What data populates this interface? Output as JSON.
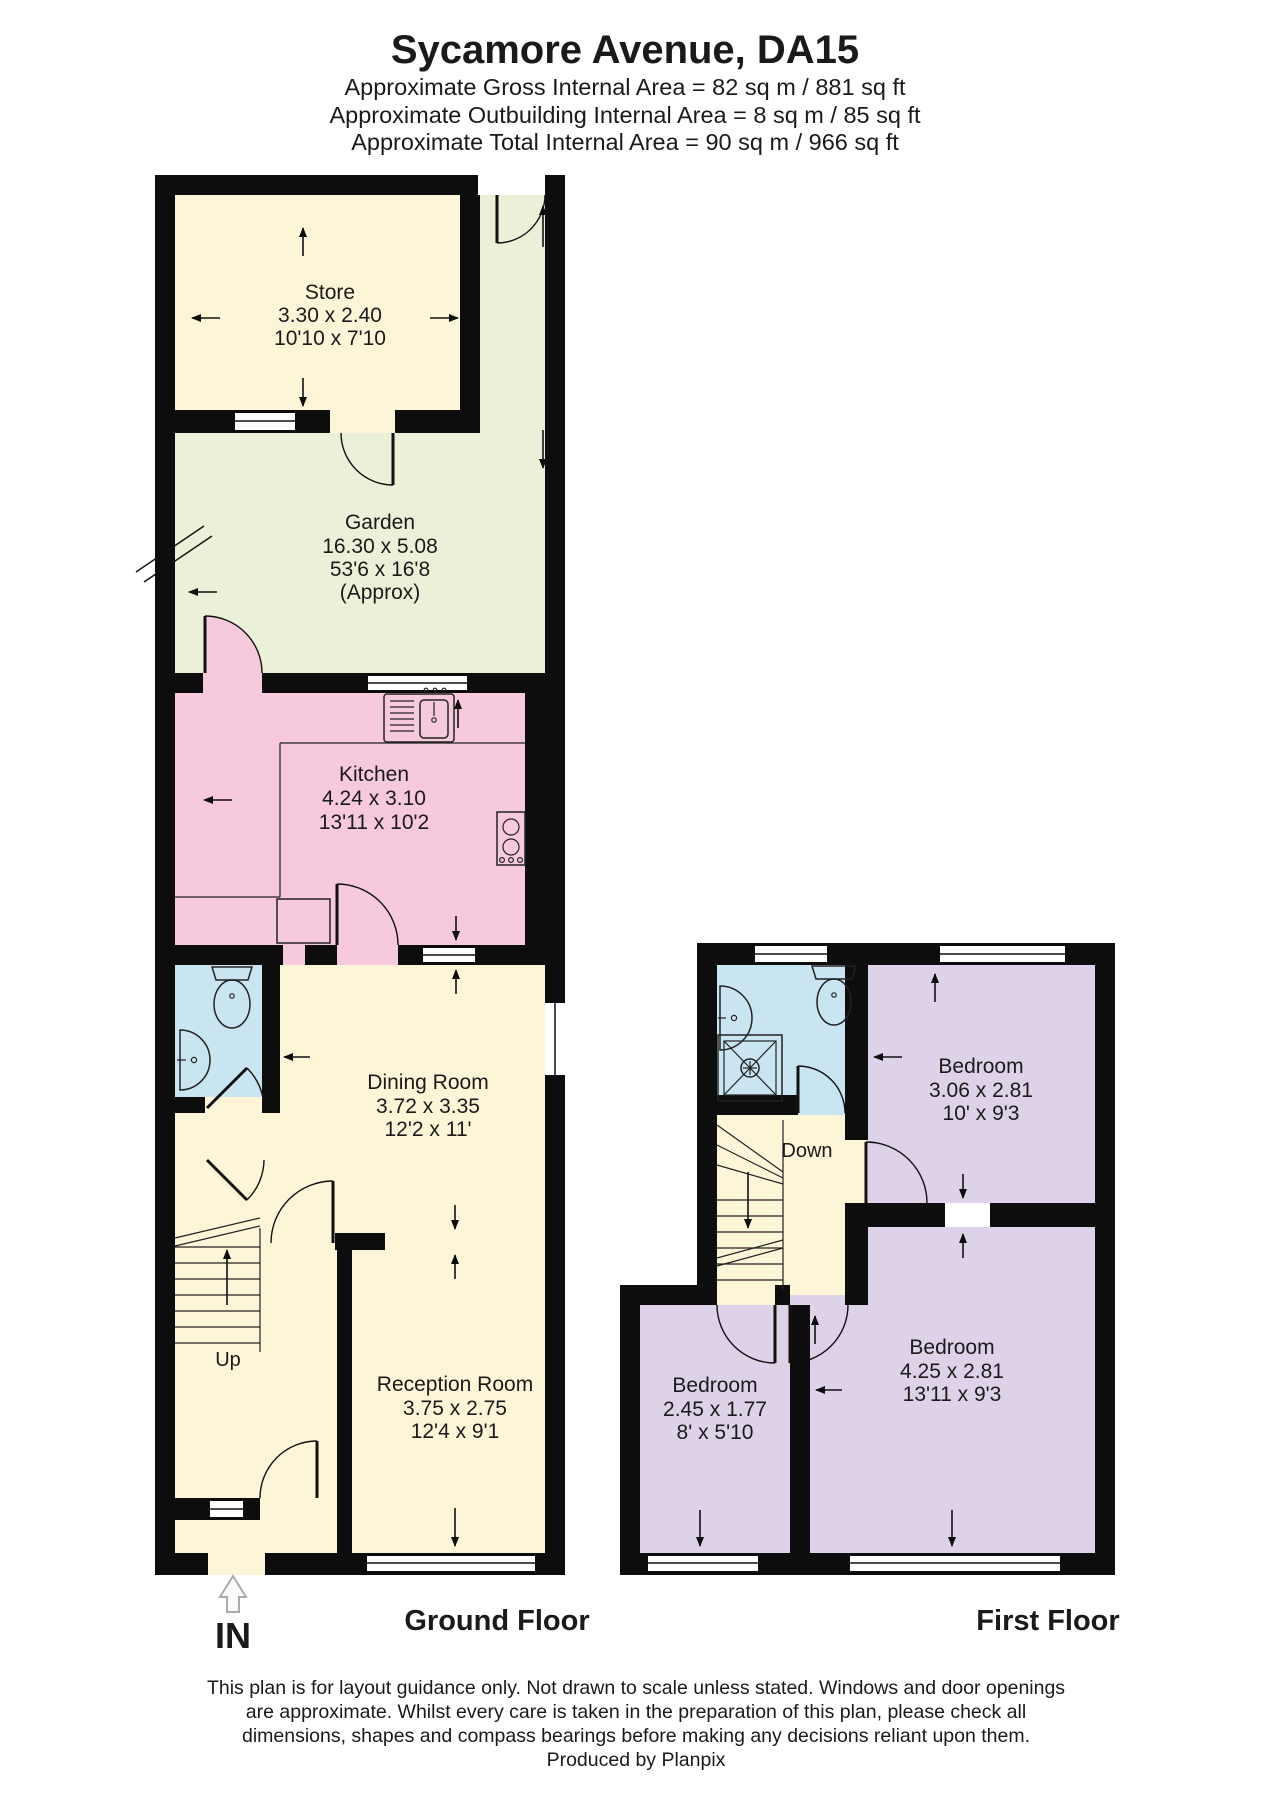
{
  "header": {
    "title": "Sycamore Avenue, DA15",
    "area_lines": [
      "Approximate Gross Internal Area = 82 sq m / 881 sq ft",
      "Approximate Outbuilding Internal Area = 8 sq m / 85 sq ft",
      "Approximate Total Internal Area = 90 sq m / 966 sq ft"
    ]
  },
  "ground_floor": {
    "label": "Ground Floor",
    "entrance": "IN",
    "stairs": "Up",
    "rooms": {
      "store": {
        "name": "Store",
        "dim_m": "3.30 x 2.40",
        "dim_ft": "10'10 x 7'10"
      },
      "garden": {
        "name": "Garden",
        "dim_m": "16.30 x 5.08",
        "dim_ft": "53'6 x 16'8",
        "note": "(Approx)"
      },
      "kitchen": {
        "name": "Kitchen",
        "dim_m": "4.24 x 3.10",
        "dim_ft": "13'11 x 10'2"
      },
      "dining_room": {
        "name": "Dining Room",
        "dim_m": "3.72 x 3.35",
        "dim_ft": "12'2 x 11'"
      },
      "reception_room": {
        "name": "Reception Room",
        "dim_m": "3.75 x 2.75",
        "dim_ft": "12'4 x 9'1"
      }
    }
  },
  "first_floor": {
    "label": "First Floor",
    "stairs": "Down",
    "rooms": {
      "bedroom_1": {
        "name": "Bedroom",
        "dim_m": "3.06 x 2.81",
        "dim_ft": "10' x 9'3"
      },
      "bedroom_2": {
        "name": "Bedroom",
        "dim_m": "2.45 x 1.77",
        "dim_ft": "8' x 5'10"
      },
      "bedroom_3": {
        "name": "Bedroom",
        "dim_m": "4.25 x 2.81",
        "dim_ft": "13'11 x 9'3"
      }
    }
  },
  "footer": {
    "lines": [
      "This plan is for layout guidance only. Not drawn to scale unless stated. Windows and door openings",
      "are approximate. Whilst every care is taken in the preparation of this plan, please check all",
      "dimensions, shapes and compass bearings before making any decisions reliant upon them.",
      "Produced by Planpix"
    ]
  },
  "colors": {
    "wall": "#0d0d0d",
    "cream": "#fcf5d8",
    "green": "#eaf1d8",
    "pink": "#f6c9dd",
    "blue": "#c9e5f2",
    "purple": "#ded2e9",
    "window": "#ffffff",
    "text": "#1a1a1a"
  }
}
